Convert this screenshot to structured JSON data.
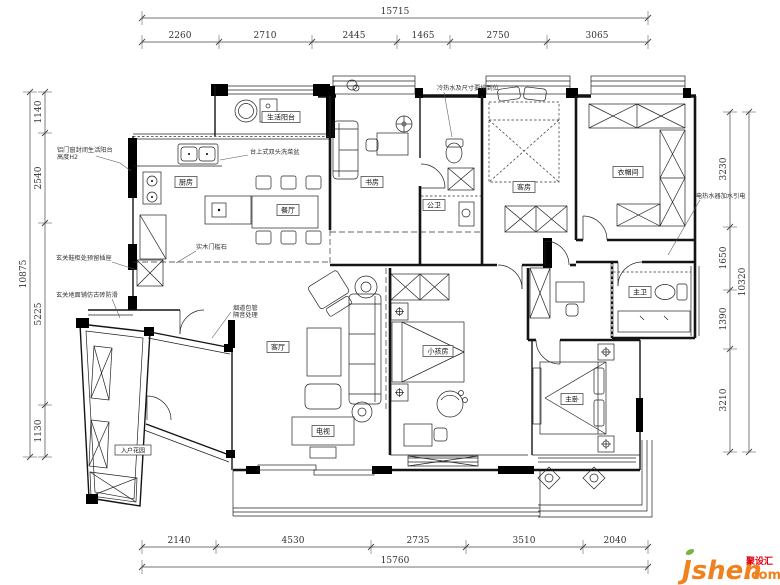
{
  "dims": {
    "top": {
      "total": "15715",
      "segments": [
        "2260",
        "2710",
        "2445",
        "1465",
        "2750",
        "3065"
      ]
    },
    "bottom": {
      "total": "15760",
      "segments": [
        "2140",
        "4530",
        "2735",
        "3510",
        "2040"
      ]
    },
    "left": {
      "total": "10875",
      "segments": [
        "1140",
        "2540",
        "5225",
        "1130"
      ]
    },
    "right": {
      "total": "10320",
      "segments": [
        "3230",
        "1650",
        "1390",
        "3210"
      ]
    }
  },
  "rooms": {
    "service_balcony": "生活阳台",
    "kitchen": "厨房",
    "dining": "餐厅",
    "study": "书房",
    "guest_bath": "公卫",
    "guest_room": "客房",
    "cloakroom": "衣帽间",
    "master_bath": "主卫",
    "living": "客厅",
    "kids_room": "小孩房",
    "tv": "电视",
    "master_bedroom": "主卧",
    "entry_garden": "入户花园"
  },
  "annotations": {
    "a1_line1": "铝门窗封闭生活阳台",
    "a1_line2": "高度H2",
    "a2": "台上式双头洗菜盆",
    "a3": "实木门槛石",
    "a4": "玄关鞋柜处预留插座",
    "a5": "玄关地面铺仿古砖防滑",
    "a6_line1": "烟道包管",
    "a6_line2": "隔音处理",
    "a7": "冷热水及尺寸要排到位",
    "a8": "电热水器加水引电"
  },
  "logo": {
    "brand": "Jsheh",
    "cn": "聚设汇",
    "tld": ".com"
  }
}
